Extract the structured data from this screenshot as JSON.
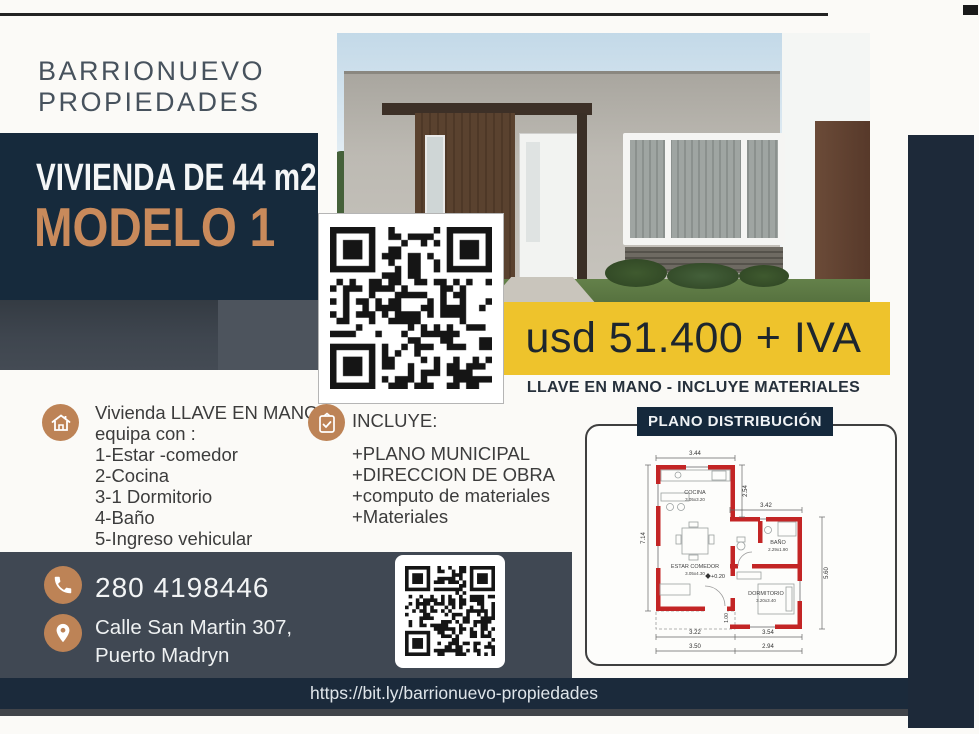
{
  "brand": {
    "line1": "BARRIONUEVO",
    "line2": "PROPIEDADES"
  },
  "headline": {
    "size": "VIVIENDA DE 44 m2",
    "model": "MODELO 1"
  },
  "price": {
    "amount": "usd 51.400 + IVA",
    "tagline": "LLAVE EN MANO - INCLUYE MATERIALES"
  },
  "features": {
    "intro1": "Vivienda LLAVE EN MANO",
    "intro2": "equipa con :",
    "items": [
      "1-Estar -comedor",
      "2-Cocina",
      "3-1 Dormitorio",
      "4-Baño",
      "5-Ingreso vehicular"
    ]
  },
  "includes": {
    "title": "INCLUYE:",
    "items": [
      "+PLANO MUNICIPAL",
      "+DIRECCION DE OBRA",
      "+computo de materiales",
      "+Materiales"
    ]
  },
  "floorplan": {
    "title": "PLANO DISTRIBUCIÓN",
    "rooms": {
      "cocina": {
        "name": "COCINA",
        "size": "3.05x3.20"
      },
      "estar": {
        "name": "ESTAR COMEDOR",
        "size": "3.05x4.30"
      },
      "bano": {
        "name": "BAÑO",
        "size": "2.29x1.90"
      },
      "dormitorio": {
        "name": "DORMITORIO",
        "size": "3.20x3.40"
      }
    },
    "dims": {
      "top": "3.44",
      "left": "7.14",
      "kitchen_height": "2.54",
      "right_width": "3.42",
      "right_height": "5.60",
      "bottom_left_inner": "3.22",
      "bottom_right_inner": "3.54",
      "bottom_left_outer": "3.50",
      "bottom_right_outer": "2.94",
      "level": "+0.20",
      "step": "1.00"
    }
  },
  "contact": {
    "phone": "280 4198446",
    "address_line1": "Calle San Martin 307,",
    "address_line2": "Puerto Madryn"
  },
  "footer": {
    "url": "https://bit.ly/barrionuevo-propiedades"
  },
  "colors": {
    "navy": "#162a3c",
    "slate": "#404853",
    "copper": "#bd8356",
    "yellow": "#eec32c",
    "plan_red": "#c32525"
  }
}
